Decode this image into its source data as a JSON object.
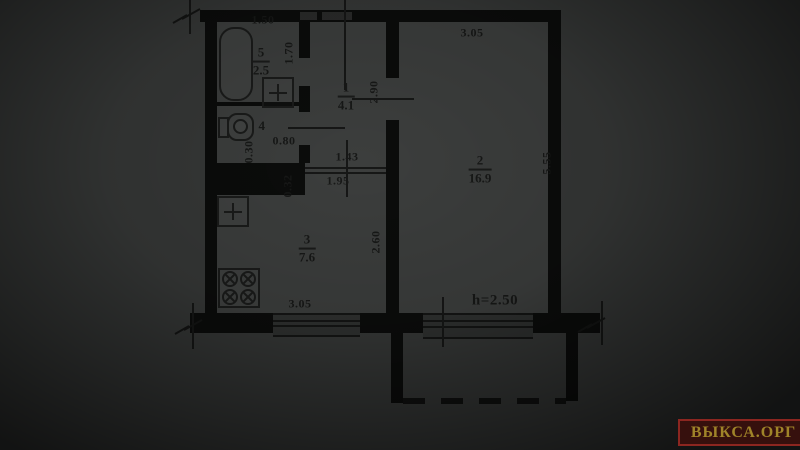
{
  "watermark": {
    "text": "ВЫКСА.ОРГ",
    "bg_color": "#36100d",
    "border_color": "#8c2620",
    "text_color": "#a08429"
  },
  "plan": {
    "rooms": {
      "hall": {
        "num": "1",
        "area": "4.1"
      },
      "living": {
        "num": "2",
        "area": "16.9"
      },
      "kitchen": {
        "num": "3",
        "area": "7.6"
      },
      "wc": {
        "num": "4",
        "area": "0.80"
      },
      "bath": {
        "num": "5",
        "area": "2.5"
      }
    },
    "dimensions": {
      "bath_width": "1.50",
      "bath_depth": "1.70",
      "hall_depth": "2.90",
      "living_width": "3.05",
      "living_depth": "5.55",
      "wc_niche": "0.30",
      "kitchen_niche": "0.32",
      "hall_width": "1.43",
      "kitchen_pass": "1.95",
      "kitchen_depth": "2.60",
      "kitchen_width": "3.05",
      "ceiling_height": "h=2.50"
    },
    "icons": {
      "bathtub": "bathtub-icon",
      "toilet": "toilet-icon",
      "bath_sink": "sink-cross-icon",
      "kitchen_sink": "sink-cross-icon",
      "stove": "stove-burners-icon"
    },
    "colors": {
      "paper": "#363837",
      "wall": "#0b0c0b",
      "text": "#171817"
    }
  }
}
